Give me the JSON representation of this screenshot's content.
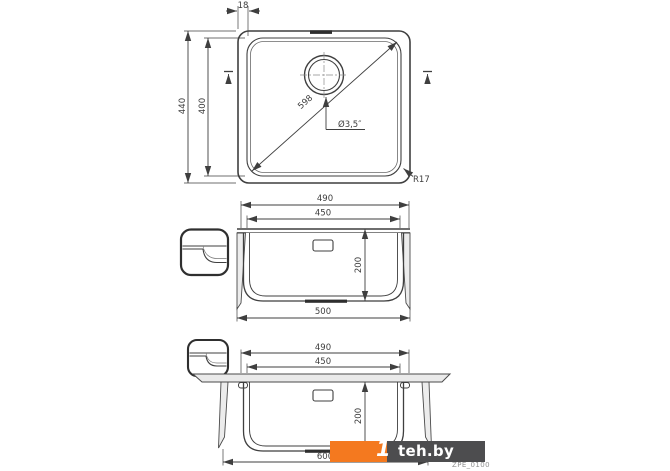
{
  "page": {
    "background": "#ffffff"
  },
  "drawing": {
    "part_code": "ZPE_0100",
    "line_color": "#3f3f3f",
    "views": {
      "top": {
        "title": "top-view",
        "dims": {
          "rim_width": "18",
          "outer_depth": "440",
          "bowl_depth": "400",
          "diagonal": "598",
          "drain_diameter": "Ø3,5″",
          "corner_radius": "R17"
        }
      },
      "front": {
        "title": "front-section",
        "dims": {
          "outer_width": "490",
          "bowl_width": "450",
          "bowl_height": "200",
          "overall_width": "500"
        }
      },
      "mounted": {
        "title": "undermount-section",
        "dims": {
          "outer_width": "490",
          "bowl_width": "450",
          "bowl_height": "200",
          "cabinet_width": "600"
        }
      }
    }
  },
  "watermark": {
    "prefix": "1",
    "site": "teh.by",
    "orange_color": "#F4791F",
    "dark_color": "#4D4D4F",
    "code_color": "#8f8f8f"
  }
}
